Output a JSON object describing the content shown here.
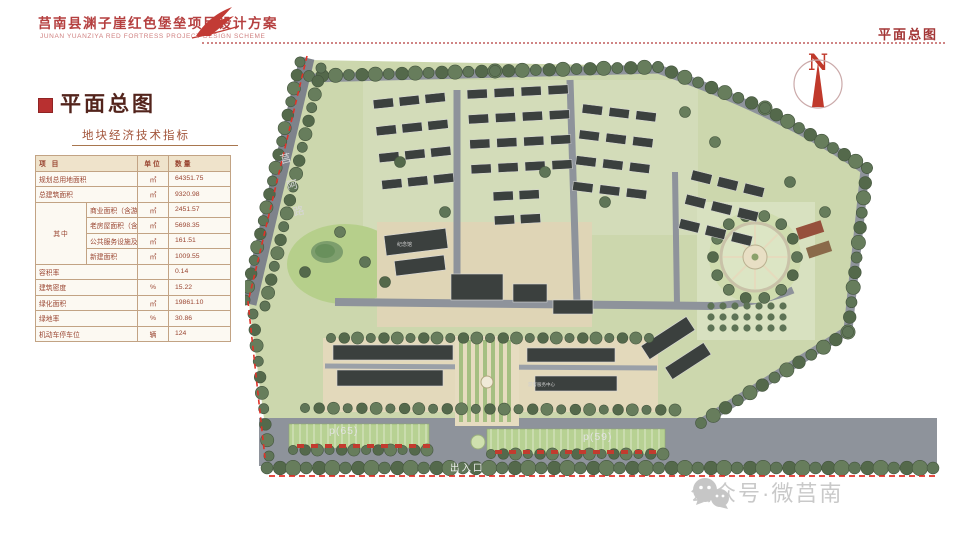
{
  "header": {
    "title_cn": "莒南县渊子崖红色堡垒项目设计方案",
    "title_en": "JUNAN YUANZIYA RED FORTRESS PROJECT DESIGN SCHEME",
    "page_label": "平面总图"
  },
  "panel": {
    "section_title": "平面总图",
    "table_title": "地块经济技术指标"
  },
  "table": {
    "headers": {
      "item": "项 目",
      "unit": "单位",
      "qty": "数量"
    },
    "rows_top": [
      {
        "name": "规划总用地面积",
        "unit": "㎡",
        "qty": "64351.75"
      },
      {
        "name": "总建筑面积",
        "unit": "㎡",
        "qty": "9320.98"
      }
    ],
    "group_label": "其中",
    "group_rows": [
      {
        "name": "商业面积（含游客中心）",
        "unit": "㎡",
        "qty": "2451.57"
      },
      {
        "name": "老房屋面积（含展馆）",
        "unit": "㎡",
        "qty": "5698.35"
      },
      {
        "name": "公共服务设施及基础设施面积",
        "unit": "㎡",
        "qty": "161.51"
      },
      {
        "name": "新建面积",
        "unit": "㎡",
        "qty": "1009.55"
      }
    ],
    "rows_bottom": [
      {
        "name": "容积率",
        "unit": "",
        "qty": "0.14"
      },
      {
        "name": "建筑密度",
        "unit": "%",
        "qty": "15.22"
      },
      {
        "name": "绿化面积",
        "unit": "㎡",
        "qty": "19861.10"
      },
      {
        "name": "绿地率",
        "unit": "%",
        "qty": "30.86"
      },
      {
        "name": "机动车停车位",
        "unit": "辆",
        "qty": "124"
      }
    ]
  },
  "plan": {
    "road_name": "莒阿路",
    "parking_left_label": "p(65)",
    "parking_right_label": "p(59)",
    "entrance_label": "出入口",
    "memorial_label": "纪念馆",
    "visitor_center_label": "游客服务中心",
    "north_label": "N"
  },
  "watermark": {
    "text": "公众号·微莒南"
  },
  "colors": {
    "accent_red": "#b54040",
    "boundary_red": "#e03228",
    "table_text": "#9a4632",
    "road_gray": "#8e939b",
    "tree_green": "#5f7557",
    "building_dark": "#3b403e"
  }
}
